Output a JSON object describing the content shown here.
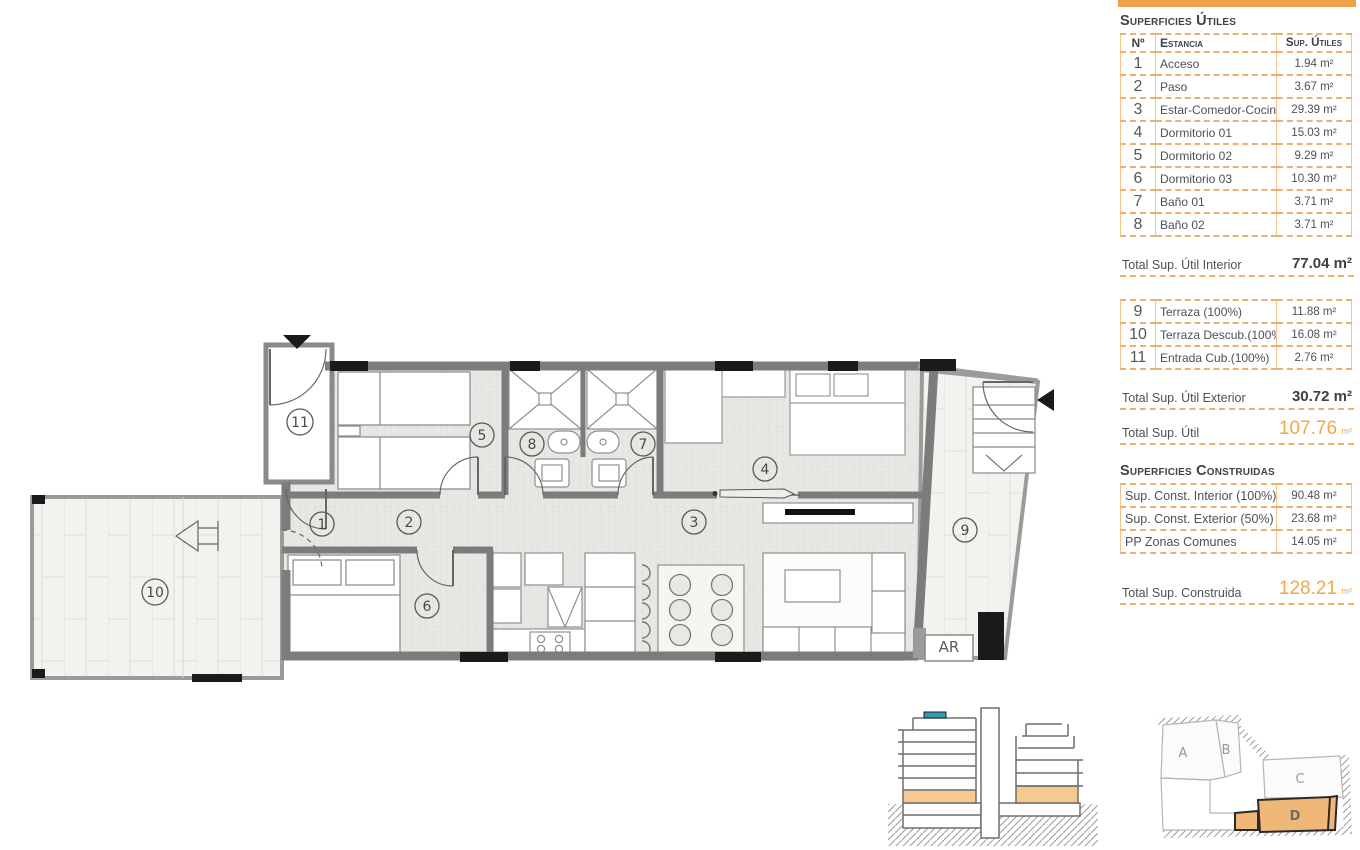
{
  "panel": {
    "title_utiles": "Superficies Útiles",
    "table_utiles": {
      "headers": {
        "num": "Nº",
        "room": "Estancia",
        "area": "Sup. Útiles"
      },
      "rows": [
        {
          "num": "1",
          "room": "Acceso",
          "area": "1.94 m²"
        },
        {
          "num": "2",
          "room": "Paso",
          "area": "3.67 m²"
        },
        {
          "num": "3",
          "room": "Estar-Comedor-Cocina",
          "area": "29.39 m²"
        },
        {
          "num": "4",
          "room": "Dormitorio 01",
          "area": "15.03 m²"
        },
        {
          "num": "5",
          "room": "Dormitorio 02",
          "area": "9.29 m²"
        },
        {
          "num": "6",
          "room": "Dormitorio 03",
          "area": "10.30 m²"
        },
        {
          "num": "7",
          "room": "Baño 01",
          "area": "3.71 m²"
        },
        {
          "num": "8",
          "room": "Baño 02",
          "area": "3.71 m²"
        }
      ]
    },
    "total_interior": {
      "label": "Total Sup. Útil Interior",
      "value": "77.04 m²"
    },
    "table_exterior": {
      "rows": [
        {
          "num": "9",
          "room": "Terraza (100%)",
          "area": "11.88 m²"
        },
        {
          "num": "10",
          "room": "Terraza Descub.(100%)",
          "area": "16.08 m²"
        },
        {
          "num": "11",
          "room": "Entrada Cub.(100%)",
          "area": "2.76 m²"
        }
      ]
    },
    "total_exterior": {
      "label": "Total Sup. Útil Exterior",
      "value": "30.72 m²"
    },
    "total_util": {
      "label": "Total Sup. Útil",
      "value": "107.76",
      "unit": "m²"
    },
    "title_construidas": "Superficies Construidas",
    "table_construidas": {
      "rows": [
        {
          "room": "Sup. Const. Interior (100%)",
          "area": "90.48 m²"
        },
        {
          "room": "Sup. Const. Exterior (50%)",
          "area": "23.68 m²"
        },
        {
          "room": "PP Zonas Comunes",
          "area": "14.05 m²"
        }
      ]
    },
    "total_construida": {
      "label": "Total Sup. Construida",
      "value": "128.21",
      "unit": "m²"
    }
  },
  "floorplan": {
    "rooms": [
      "1",
      "2",
      "3",
      "4",
      "5",
      "6",
      "7",
      "8",
      "9",
      "10",
      "11"
    ],
    "ar": "AR"
  },
  "keyplan": {
    "blocks": [
      "A",
      "B",
      "C",
      "D"
    ],
    "highlighted": "D"
  },
  "colors": {
    "accent_orange": "#F0A24A",
    "table_border": "#EDB071",
    "total_orange": "#F2A74B",
    "wall_gray": "#7C7C7C",
    "section_teal": "#2E9AB3",
    "keyplan_orange": "#F0B878"
  }
}
